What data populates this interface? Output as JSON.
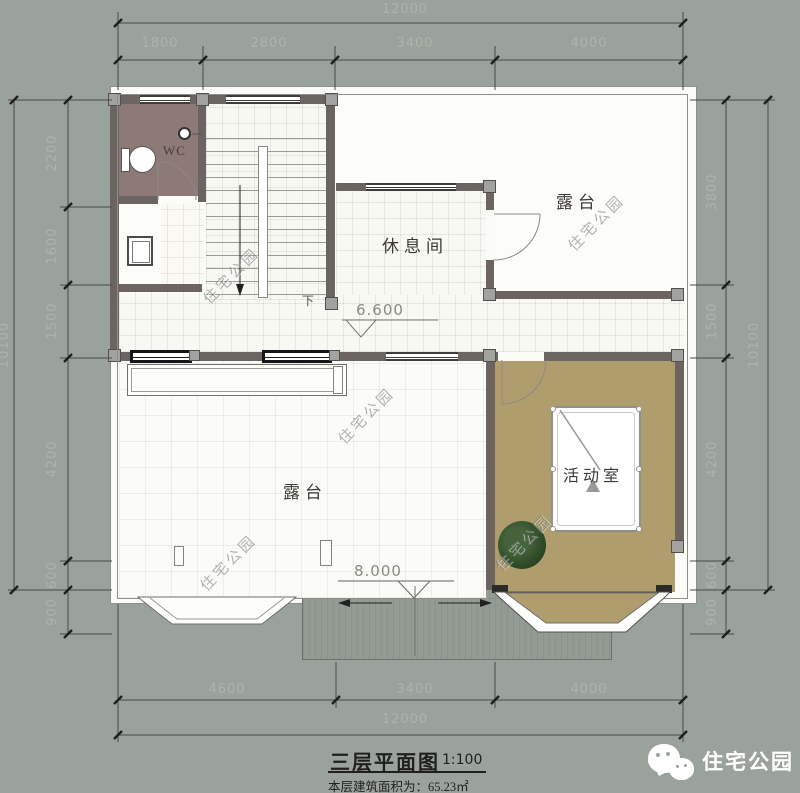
{
  "colors": {
    "background": "#99a39b",
    "wall": "#6c6461",
    "plan_floor": "#fbfbf8",
    "wc_floor": "#8d7a76",
    "activity_floor": "#b09d6e",
    "plant_green": "#2f4c28",
    "dimension_text": "#adb4ab",
    "brand_text": "#ffffff"
  },
  "dimensions": {
    "top": {
      "total": "12000",
      "segments": [
        "1800",
        "2800",
        "3400",
        "4000"
      ]
    },
    "bottom": {
      "total": "12000",
      "segments": [
        "4600",
        "3400",
        "4000"
      ]
    },
    "left": {
      "total": "10100",
      "segments": [
        "2200",
        "1600",
        "1500",
        "4200",
        "600",
        "900"
      ]
    },
    "right": {
      "total": "10100",
      "segments": [
        "3800",
        "1500",
        "4200",
        "600",
        "900"
      ]
    }
  },
  "rooms": {
    "wc": "WC",
    "terrace_top": "露台",
    "rest_room": "休息间",
    "terrace_bottom": "露台",
    "activity_room": "活动室",
    "stairs_down": "下"
  },
  "levels": {
    "floor": "6.600",
    "lower_roof": "8.000"
  },
  "title": {
    "name": "三层平面图",
    "scale": "1:100",
    "area_note": "本层建筑面积为：65.23㎡"
  },
  "branding": {
    "name": "住宅公园",
    "icon": "wechat-icon"
  },
  "watermark": {
    "text": "住宅公园"
  }
}
